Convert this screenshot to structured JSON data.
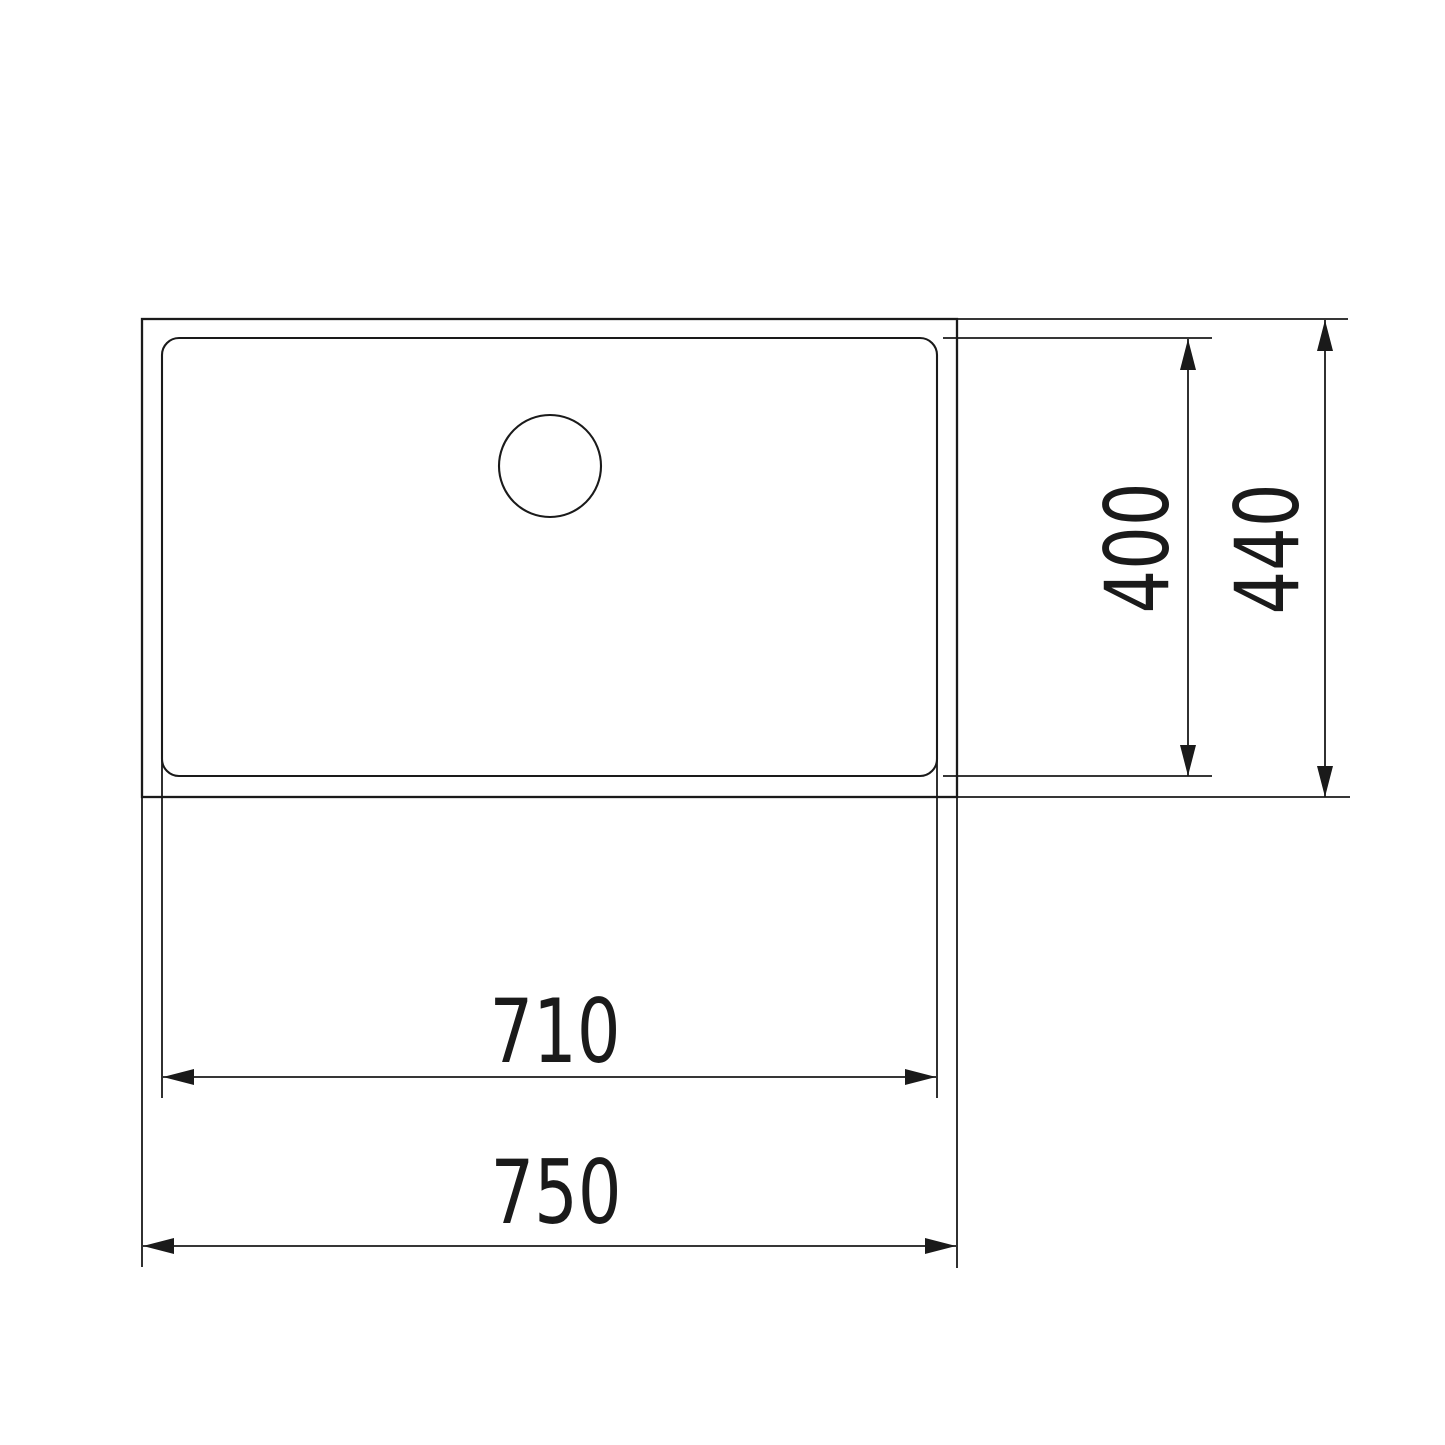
{
  "page": {
    "background": "#ffffff",
    "line_color": "#1a1a1a",
    "description": "Technical dimension drawing, top view of an undermount sink bowl with drain hole"
  },
  "drawing": {
    "units_implied": "mm",
    "labels": {
      "inner_width": "710",
      "outer_width": "750",
      "inner_depth": "400",
      "outer_depth": "440"
    }
  }
}
